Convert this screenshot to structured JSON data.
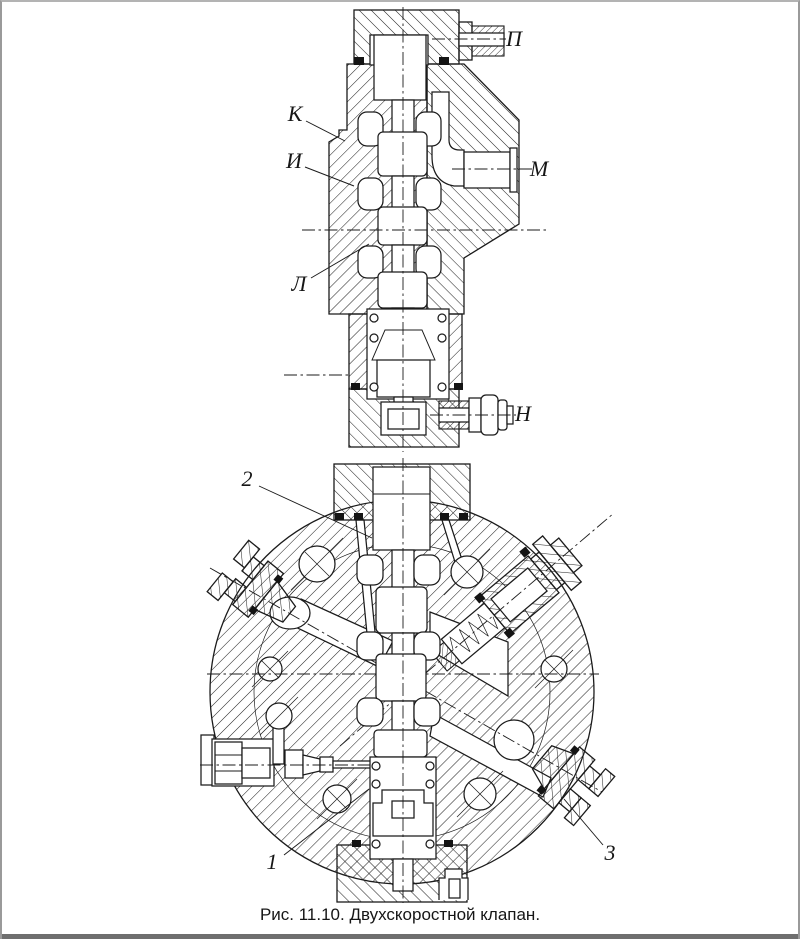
{
  "page": {
    "background": "#ffffff",
    "frame_color": "#9a9a9a",
    "bottom_bar_color": "#6f6f6f",
    "line_color": "#1b1b1b"
  },
  "figure": {
    "caption": "Рис. 11.10. Двухскоростной клапан.",
    "part_labels": {
      "P": "П",
      "K": "К",
      "I": "И",
      "M": "М",
      "L": "Л",
      "N": "Н",
      "item1": "1",
      "item2": "2",
      "item3": "3"
    }
  }
}
